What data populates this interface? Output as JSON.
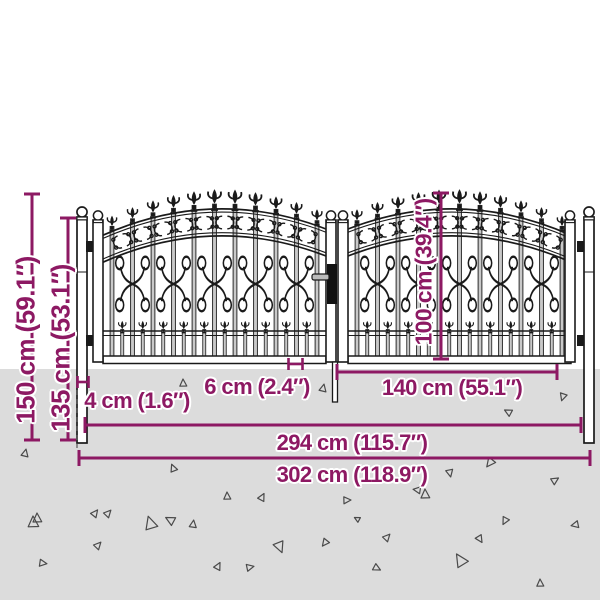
{
  "diagram": {
    "dimensions": {
      "total_height": "150 cm (59.1″)",
      "frame_height": "135 cm (53.1″)",
      "leaf_height": "100 cm (39.4″)",
      "post_width": "4 cm (1.6″)",
      "bar_spacing": "6 cm (2.4″)",
      "leaf_width": "140 cm (55.1″)",
      "inner_width": "294 cm (115.7″)",
      "total_width": "302 cm (118.9″)"
    },
    "colors": {
      "dimension": "#8d1963",
      "gate_line": "#1a1a1a",
      "bar_fill": "#c9c9c9",
      "ground": "#dcdcdc",
      "background": "#ffffff",
      "triangle": "#4a4a4a"
    }
  }
}
